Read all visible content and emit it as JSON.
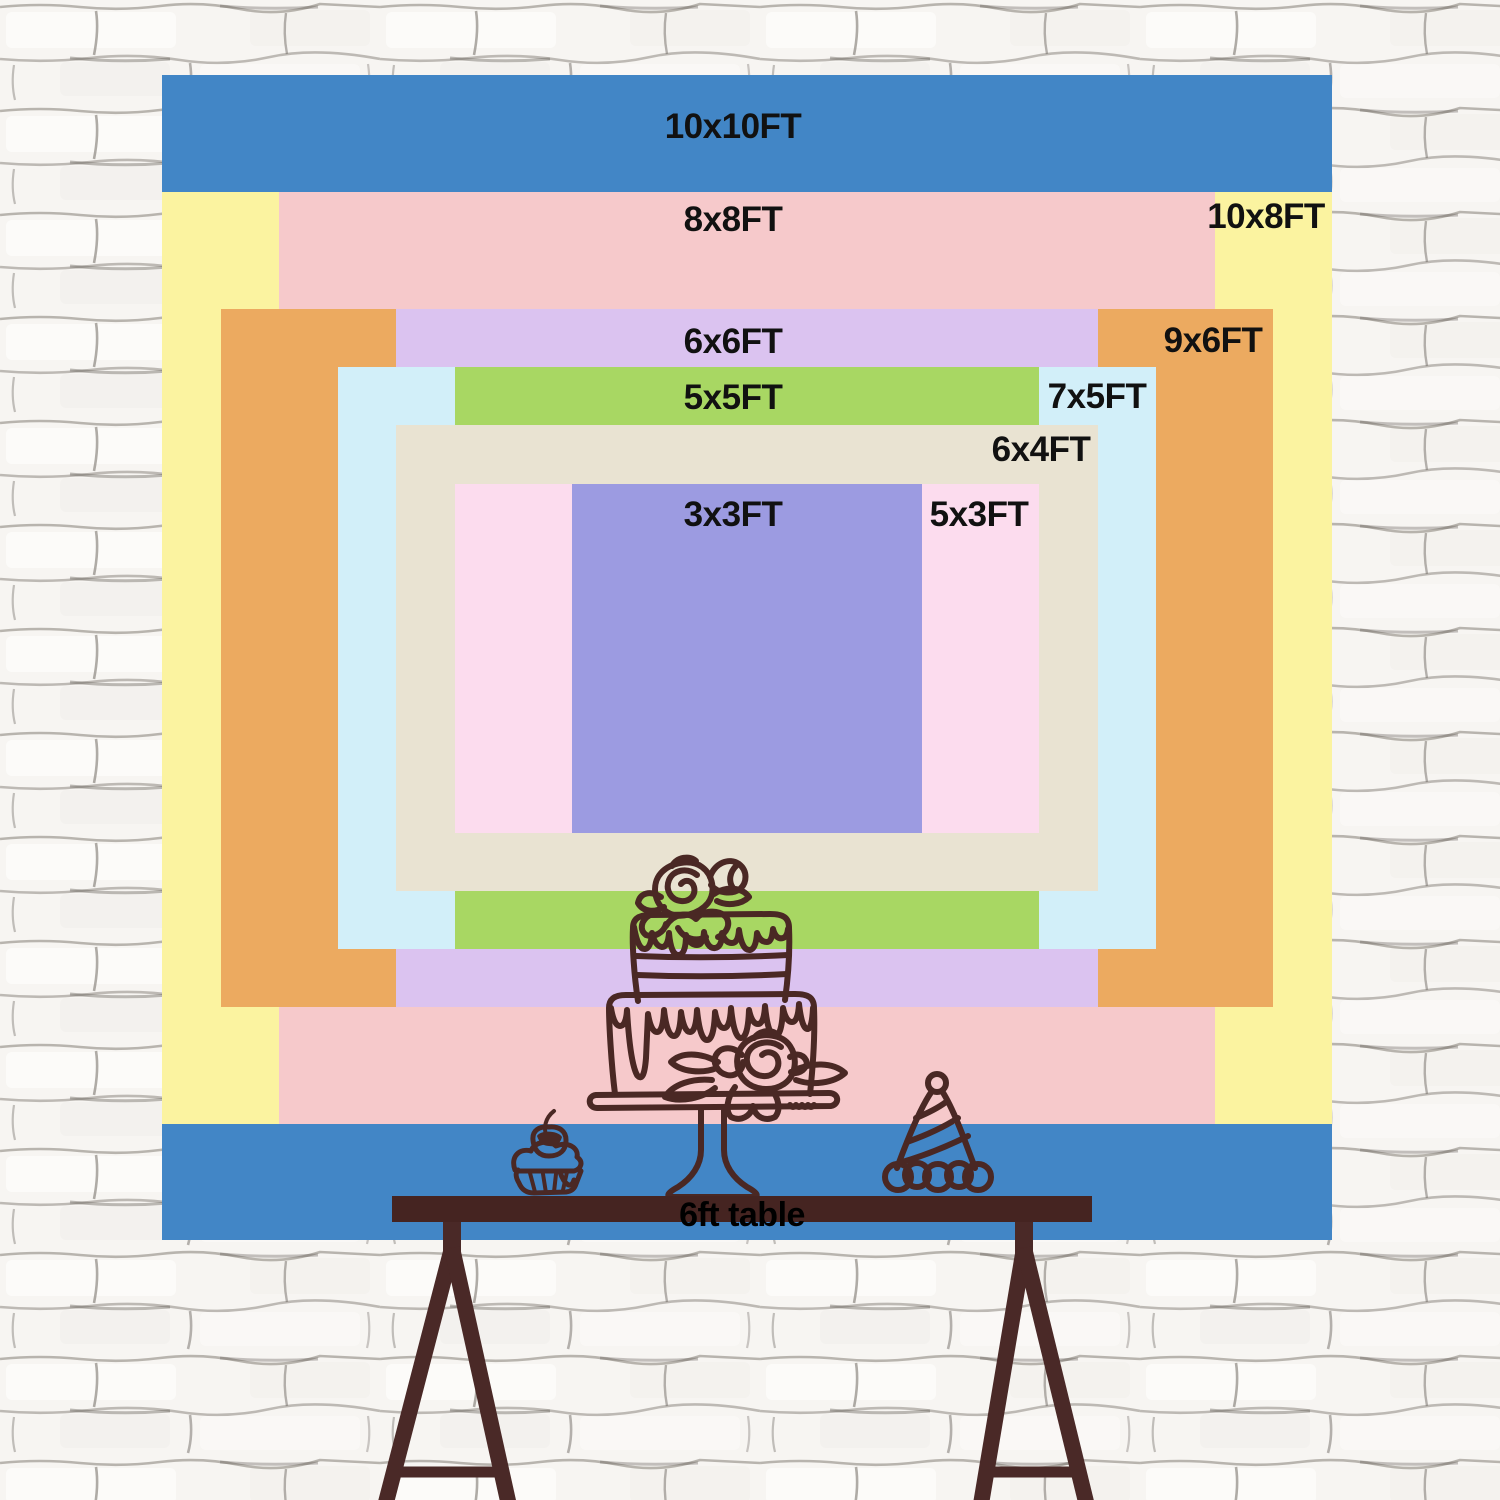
{
  "scene": {
    "background_color": "#f6f4f1",
    "wall_texture": "white-painted-brick"
  },
  "size_chart": {
    "unit": "FT",
    "label_color": "#111111",
    "layers": [
      {
        "id": "10x10",
        "label": "10x10FT",
        "width_ft": 10,
        "height_ft": 10,
        "color": "#4286c6"
      },
      {
        "id": "10x8",
        "label": "10x8FT",
        "width_ft": 10,
        "height_ft": 8,
        "color": "#fbf3a0"
      },
      {
        "id": "8x8",
        "label": "8x8FT",
        "width_ft": 8,
        "height_ft": 8,
        "color": "#f6c9cb"
      },
      {
        "id": "9x6",
        "label": "9x6FT",
        "width_ft": 9,
        "height_ft": 6,
        "color": "#ecaa60"
      },
      {
        "id": "6x6",
        "label": "6x6FT",
        "width_ft": 6,
        "height_ft": 6,
        "color": "#dbc3f0"
      },
      {
        "id": "7x5",
        "label": "7x5FT",
        "width_ft": 7,
        "height_ft": 5,
        "color": "#d2eff9"
      },
      {
        "id": "5x5",
        "label": "5x5FT",
        "width_ft": 5,
        "height_ft": 5,
        "color": "#a8d763"
      },
      {
        "id": "6x4",
        "label": "6x4FT",
        "width_ft": 6,
        "height_ft": 4,
        "color": "#e9e3d2"
      },
      {
        "id": "5x3",
        "label": "5x3FT",
        "width_ft": 5,
        "height_ft": 3,
        "color": "#fcdcee"
      },
      {
        "id": "3x3",
        "label": "3x3FT",
        "width_ft": 3,
        "height_ft": 3,
        "color": "#9c9be1"
      }
    ]
  },
  "table": {
    "label": "6ft table",
    "bar_color": "#452421",
    "leg_color": "#4a2927",
    "text_color": "#000000"
  },
  "illustration": {
    "line_color": "#4a2824",
    "items": [
      "two-tier-cake-on-stand",
      "cupcake-with-cherry",
      "party-hat"
    ]
  }
}
